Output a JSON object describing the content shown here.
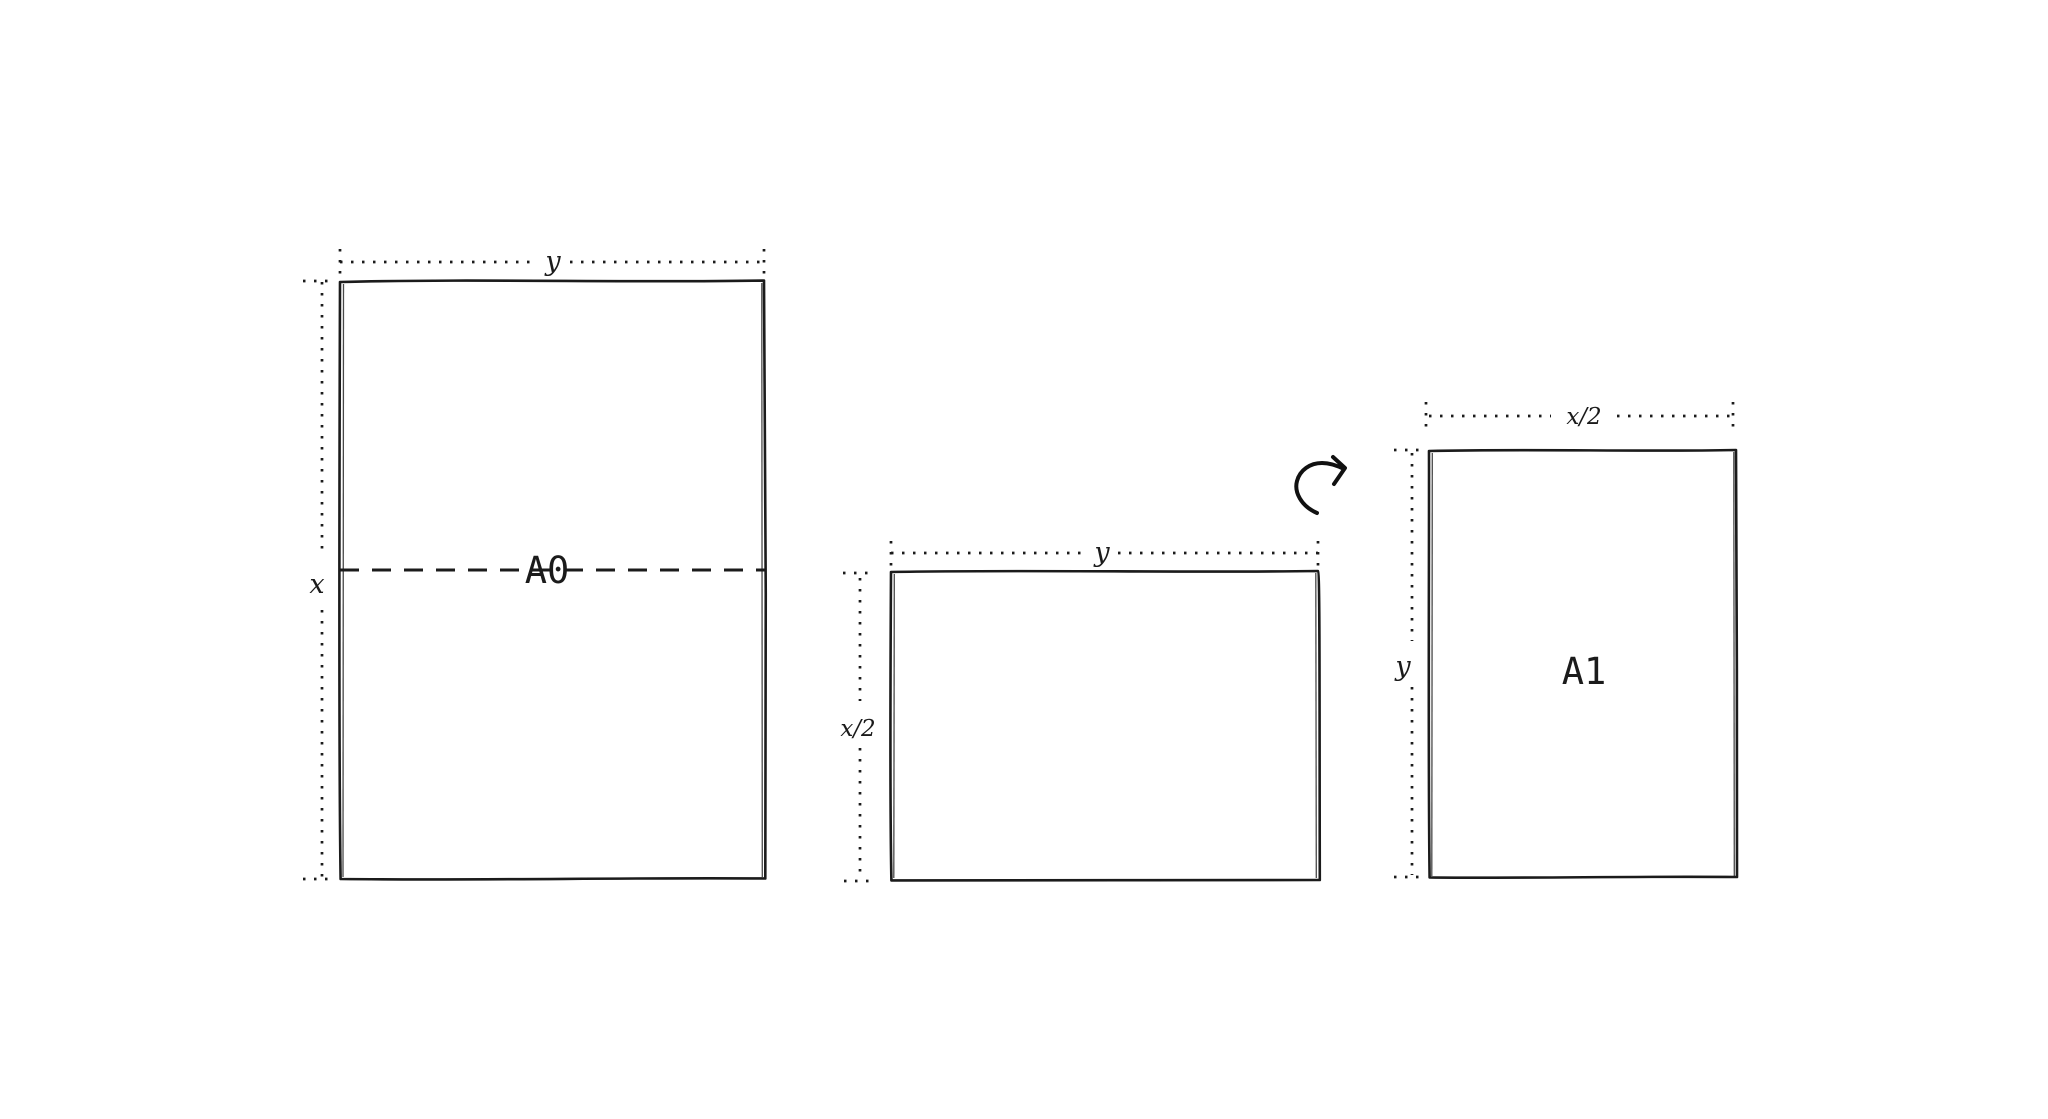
{
  "canvas": {
    "background_color": "#ffffff",
    "ink_color": "#1b1b1b"
  },
  "figure": {
    "a0_sheet": {
      "label": "A0",
      "width_dim_label": "y",
      "height_dim_label": "x"
    },
    "a1_landscape_sheet": {
      "width_dim_label": "y",
      "height_dim_label": "x/2"
    },
    "a1_portrait_sheet": {
      "label": "A1",
      "width_dim_label": "x/2",
      "height_dim_label": "y"
    }
  },
  "icons": {
    "rotate_arrow": "curved-rotate-arrow"
  }
}
